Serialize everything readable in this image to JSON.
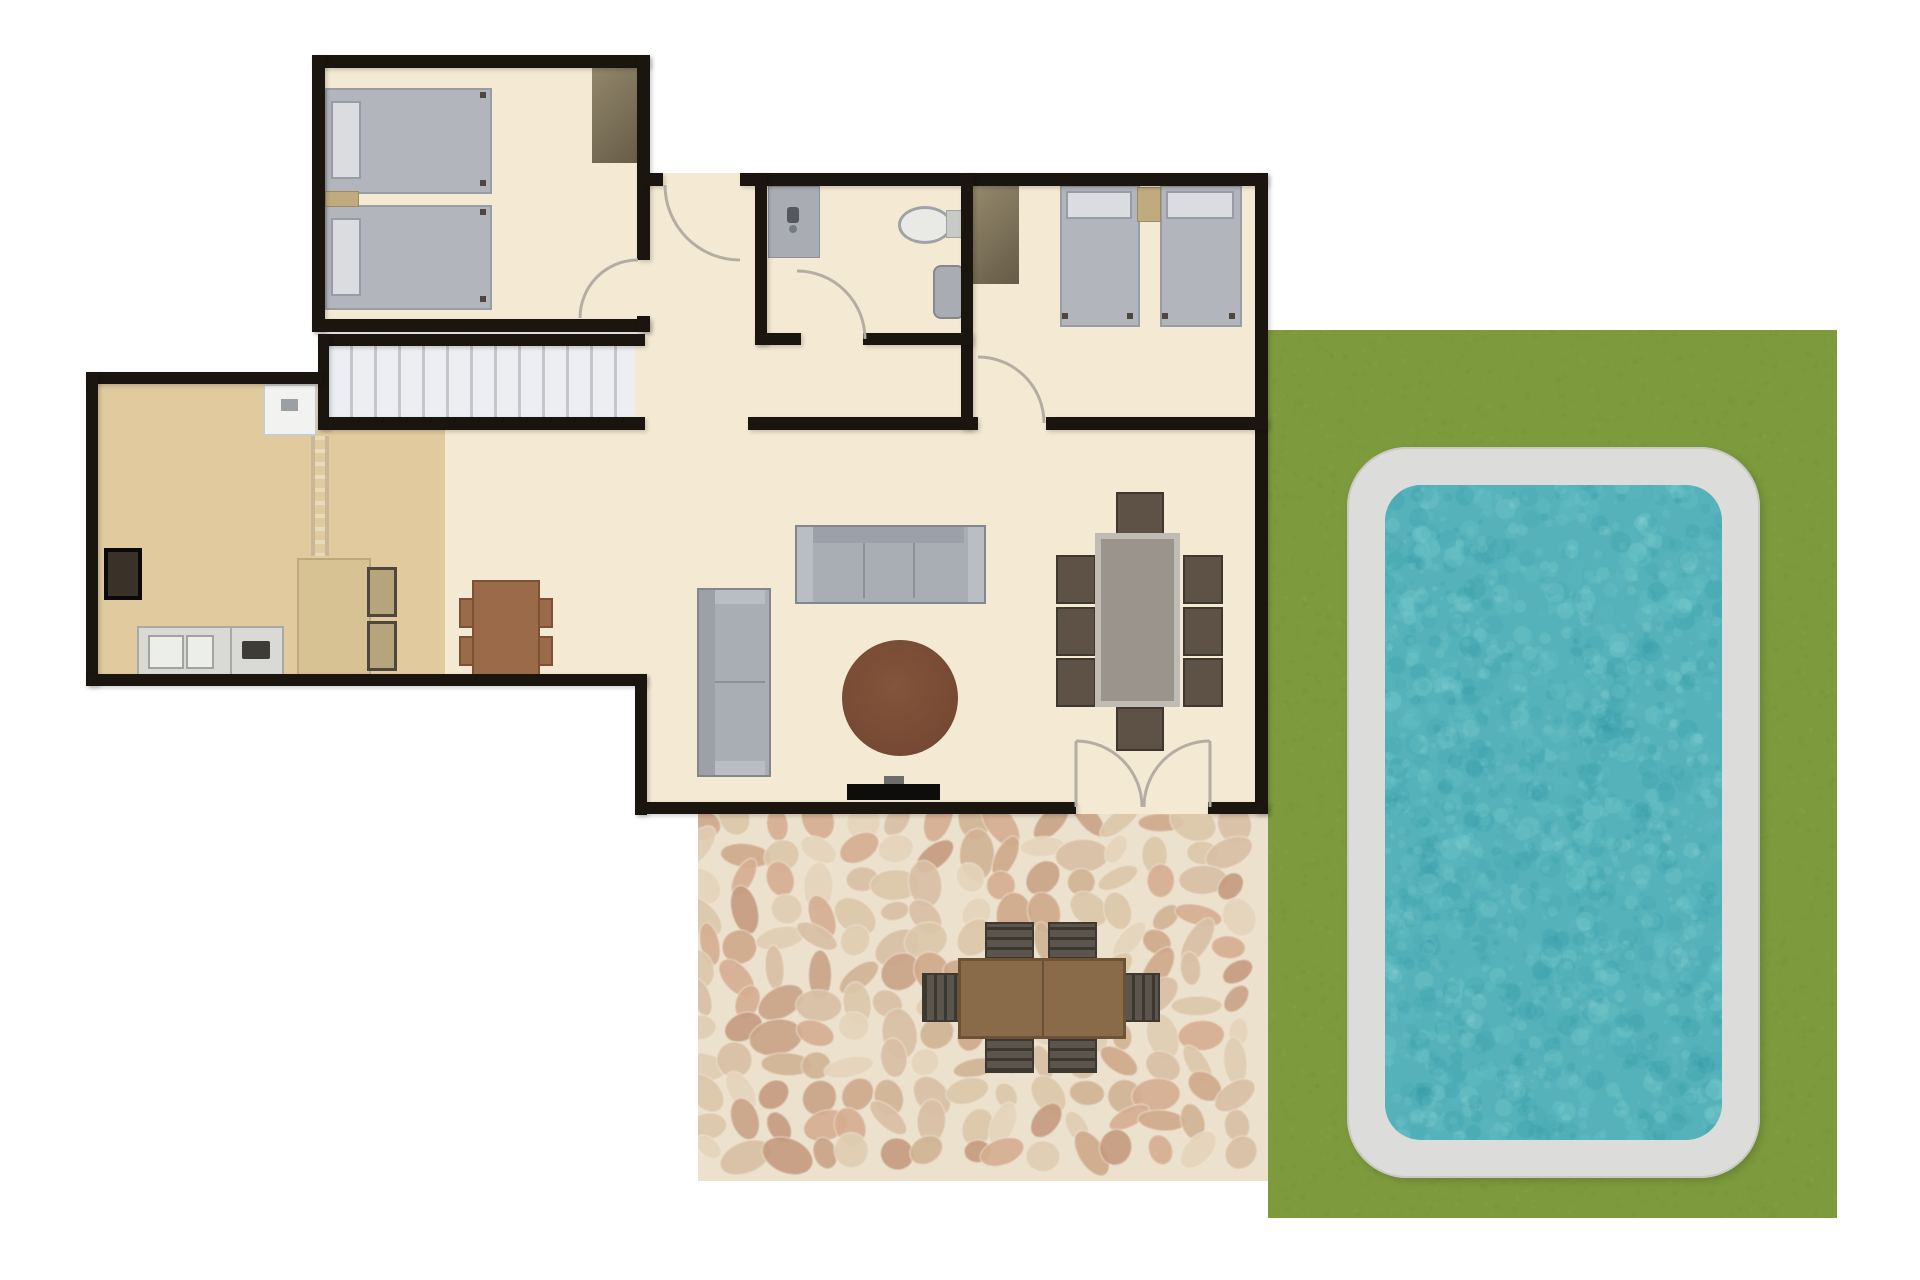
{
  "scene": {
    "type": "floor-plan",
    "title": "Villa ground-floor plan with patio and swimming pool",
    "orientation": "top-down"
  },
  "rooms": [
    {
      "name": "bedroom-1",
      "position": "top-left",
      "furniture": [
        "twin-bed",
        "twin-bed",
        "nightstand",
        "wardrobe",
        "door"
      ]
    },
    {
      "name": "entry-hall",
      "position": "top-middle",
      "furniture": [
        "entry-door"
      ]
    },
    {
      "name": "bathroom",
      "position": "top-middle",
      "furniture": [
        "vanity-sink",
        "toilet",
        "bidet",
        "door"
      ]
    },
    {
      "name": "bedroom-2",
      "position": "top-right",
      "furniture": [
        "twin-bed",
        "twin-bed",
        "nightstand",
        "wardrobe",
        "door"
      ]
    },
    {
      "name": "kitchen",
      "position": "left",
      "furniture": [
        "refrigerator",
        "oven",
        "sink-counter",
        "cooktop",
        "island",
        "bar-stool",
        "bar-stool",
        "table-for-four",
        "ladder"
      ]
    },
    {
      "name": "staircase",
      "position": "center",
      "furniture": [
        "stairs-13-treads"
      ]
    },
    {
      "name": "living-dining-room",
      "position": "center",
      "furniture": [
        "three-seat-sofa",
        "two-seat-sofa",
        "round-coffee-table",
        "tv",
        "dining-table",
        "8-dining-chairs",
        "double-patio-door"
      ]
    },
    {
      "name": "patio",
      "position": "bottom",
      "furniture": [
        "outdoor-table",
        "6-outdoor-chairs"
      ],
      "surface": "cobblestone"
    },
    {
      "name": "garden",
      "position": "right",
      "furniture": [
        "swimming-pool"
      ],
      "surface": "grass"
    }
  ],
  "counts": {
    "bedrooms": 2,
    "bathrooms": 1,
    "twin_beds": 4,
    "sofas": 2,
    "indoor_dining_seats": 8,
    "kitchen_table_seats": 4,
    "island_stools": 2,
    "outdoor_dining_seats": 6,
    "stair_treads": 13
  },
  "colors": {
    "wall": "#1a150f",
    "floor": "#f4ead3",
    "kitchenFloor": "#e1cb9e",
    "grass": "#7d9b3d",
    "poolDeck": "#dcdcda",
    "water": "#55b2ba",
    "stoneBase": "#ece1cc",
    "bed": "#b2b6bc",
    "pillow": "#dadce0",
    "bedBorder": "#989da5",
    "nightstand": "#c0ab7f",
    "wardrobeLight": "#94896c",
    "wardrobeDark": "#655b47",
    "vanity": "#a9adb3",
    "applianceWhite": "#f2f3f1",
    "counter": "#d9dad6",
    "counterBorder": "#a9aaa6",
    "island": "#d7c294",
    "islandBorder": "#bfa97c",
    "stoolOlive": "#b5a47c",
    "woodTable": "#9b6a49",
    "sofaFill": "#a9adb4",
    "coffeeTable": "#6f4530",
    "diningTable": "#9b948c",
    "diningTableRim": "#c1bcb3",
    "chairDark": "#5d5245",
    "patioTable": "#8a6b49",
    "patioChair": "#5b554c",
    "doorArc": "#b4aea2",
    "stairTread": "#eceef1",
    "stairLine": "#c3c7cd",
    "ladderRail": "#c9b795",
    "ladderRung": "#e8dbbc"
  },
  "palettes": {
    "stones": [
      "#dcc6a9",
      "#d0b294",
      "#c49a7e",
      "#d8bfa4",
      "#e4d4ba",
      "#c9a386",
      "#d5ad90",
      "#cfa98b",
      "#e0cdb2"
    ],
    "water": [
      "#6fc8cc",
      "#3da0ac",
      "#8ad4d6",
      "#2f95a4",
      "#63bcc2"
    ],
    "grass": [
      "#6b8a31",
      "#8fae4b",
      "#74933a",
      "#87a544"
    ]
  }
}
